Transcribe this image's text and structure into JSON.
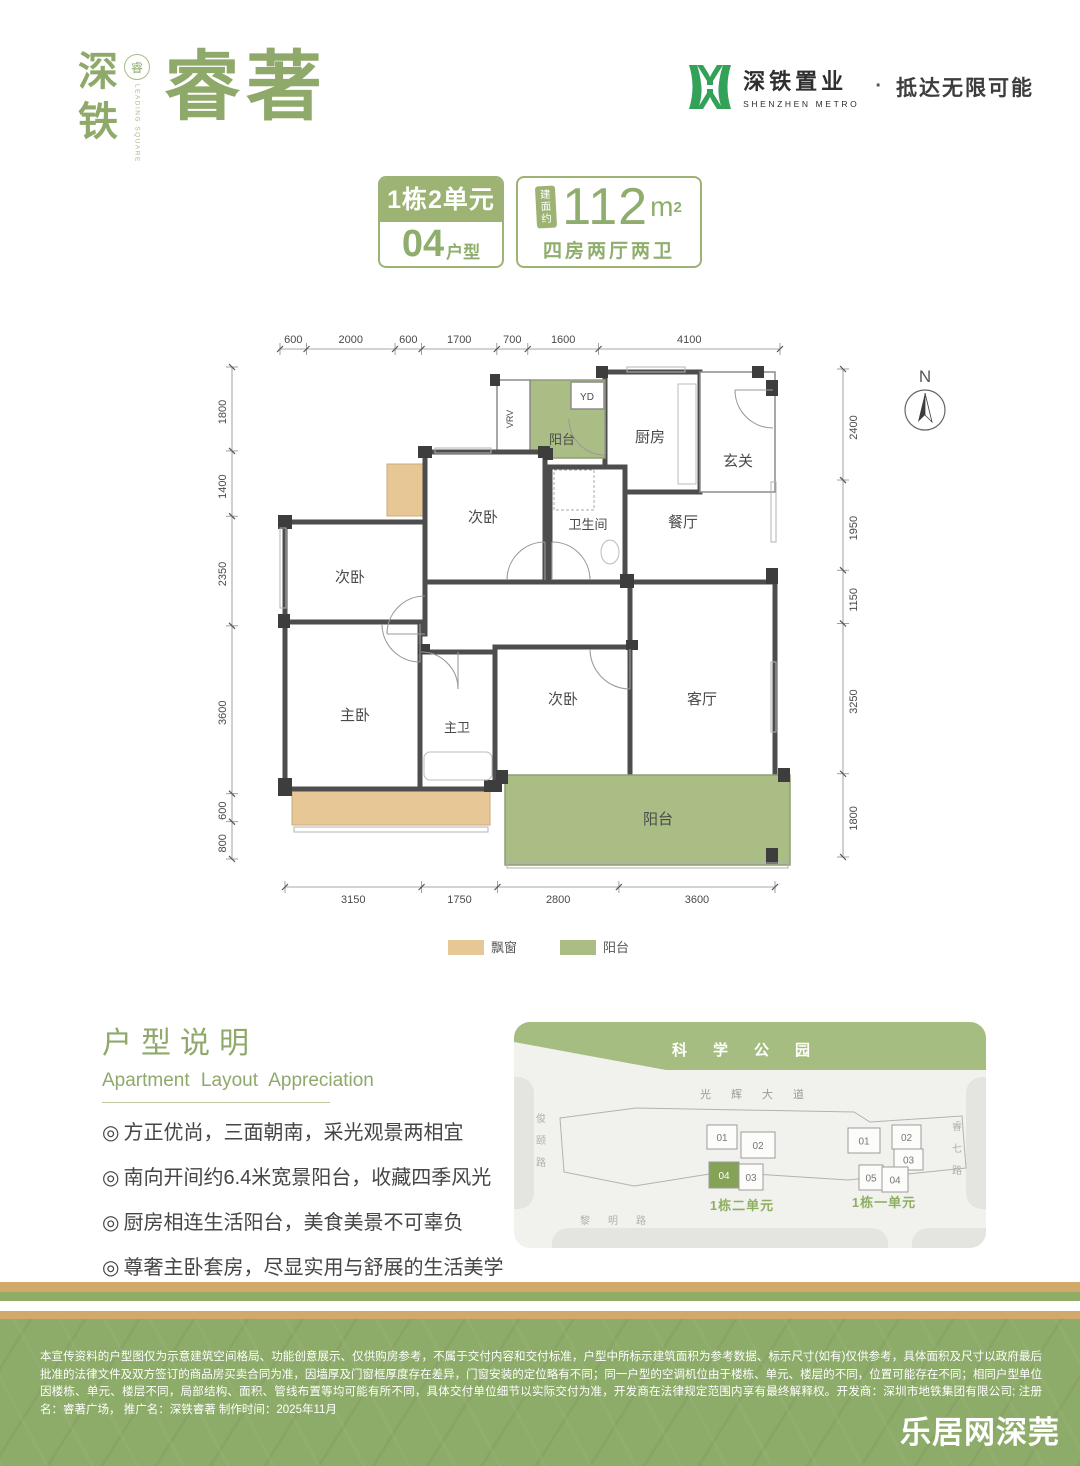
{
  "header": {
    "logo_vertical": "深铁",
    "logo_seal_char": "睿",
    "logo_seal_text": "LEADING SQUARE",
    "logo_main": "睿著",
    "brand_cn": "深铁置业",
    "brand_en": "SHENZHEN METRO",
    "dot": "·",
    "tagline": "抵达无限可能"
  },
  "badges": {
    "block": "1栋2单元",
    "unit_num": "04",
    "unit_suffix": "户型",
    "area_tag": "建面约",
    "area_num": "112",
    "area_unit": "m",
    "area_sup": "2",
    "rooms_desc": "四房两厅两卫"
  },
  "floorplan": {
    "compass": {
      "label": "N",
      "x": 745,
      "y": 88,
      "r": 20
    },
    "dims": {
      "top": {
        "y": 27,
        "from": 100,
        "to": 600,
        "values": [
          600,
          2000,
          600,
          1700,
          700,
          1600,
          4100
        ]
      },
      "left": {
        "x": 52,
        "from": 45,
        "to": 537,
        "values": [
          1800,
          1400,
          2350,
          3600,
          600,
          800
        ]
      },
      "right": {
        "x": 663,
        "from": 47,
        "to": 535,
        "values": [
          2400,
          1950,
          1150,
          3250,
          1800
        ]
      },
      "bottom": {
        "y": 565,
        "from": 105,
        "to": 595,
        "values": [
          3150,
          1750,
          2800,
          3600
        ]
      }
    },
    "rooms": [
      {
        "label": "厨房",
        "x": 425,
        "y": 50,
        "w": 95,
        "h": 120,
        "fill": "white",
        "stroke": "wall",
        "lx": 470,
        "ly": 120,
        "fs": 15
      },
      {
        "label": "玄关",
        "x": 520,
        "y": 50,
        "w": 75,
        "h": 120,
        "fill": "white",
        "stroke": "thin",
        "lx": 558,
        "ly": 144,
        "fs": 15
      },
      {
        "label": "阳台",
        "x": 350,
        "y": 58,
        "w": 75,
        "h": 78,
        "fill": "balcony",
        "stroke": "glass",
        "lx": 382,
        "ly": 122,
        "fs": 13
      },
      {
        "label": "YD",
        "x": 391,
        "y": 60,
        "w": 33,
        "h": 27,
        "fill": "white",
        "stroke": "thin",
        "lx": 407,
        "ly": 78,
        "fs": 10
      },
      {
        "label": "VRV",
        "x": 317,
        "y": 58,
        "w": 33,
        "h": 78,
        "fill": "white",
        "stroke": "thin",
        "lx": 333,
        "ly": 97,
        "fs": 9,
        "vertical": true
      },
      {
        "label": "次卧",
        "x": 245,
        "y": 130,
        "w": 120,
        "h": 130,
        "fill": "white",
        "stroke": "wall",
        "lx": 303,
        "ly": 200,
        "fs": 15
      },
      {
        "label": "卫生间",
        "x": 370,
        "y": 145,
        "w": 75,
        "h": 115,
        "fill": "white",
        "stroke": "wall",
        "lx": 408,
        "ly": 207,
        "fs": 13
      },
      {
        "label": "餐厅",
        "x": 445,
        "y": 170,
        "w": 150,
        "h": 90,
        "fill": "none",
        "stroke": "none",
        "lx": 503,
        "ly": 205,
        "fs": 15
      },
      {
        "label": "次卧",
        "x": 105,
        "y": 200,
        "w": 140,
        "h": 112,
        "fill": "white",
        "stroke": "wall",
        "lx": 170,
        "ly": 260,
        "fs": 15
      },
      {
        "label": "主卧",
        "x": 105,
        "y": 300,
        "w": 135,
        "h": 167,
        "fill": "white",
        "stroke": "wall",
        "lx": 175,
        "ly": 398,
        "fs": 15
      },
      {
        "label": "主卫",
        "x": 240,
        "y": 330,
        "w": 75,
        "h": 137,
        "fill": "white",
        "stroke": "wall",
        "lx": 277,
        "ly": 410,
        "fs": 13
      },
      {
        "label": "次卧",
        "x": 315,
        "y": 325,
        "w": 135,
        "h": 130,
        "fill": "white",
        "stroke": "wall",
        "lx": 383,
        "ly": 382,
        "fs": 15
      },
      {
        "label": "客厅",
        "x": 450,
        "y": 260,
        "w": 145,
        "h": 207,
        "fill": "white",
        "stroke": "wall",
        "lx": 522,
        "ly": 382,
        "fs": 15
      },
      {
        "label": "阳台",
        "x": 325,
        "y": 453,
        "w": 285,
        "h": 90,
        "fill": "balcony",
        "stroke": "glass",
        "lx": 478,
        "ly": 502,
        "fs": 15
      }
    ],
    "bays": [
      {
        "x": 108,
        "y": 204,
        "w": 28,
        "h": 84
      },
      {
        "x": 207,
        "y": 142,
        "w": 40,
        "h": 52
      },
      {
        "x": 112,
        "y": 469,
        "w": 198,
        "h": 34
      }
    ],
    "legend": [
      {
        "label": "飘窗",
        "color": "#e6c795"
      },
      {
        "label": "阳台",
        "color": "#a9bd84"
      }
    ]
  },
  "description": {
    "title": "户型说明",
    "subtitle": "Apartment Layout Appreciation",
    "marker": "◎",
    "bullets": [
      "方正优尚，三面朝南，采光观景两相宜",
      "南向开间约6.4米宽景阳台，收藏四季风光",
      "厨房相连生活阳台，美食美景不可辜负",
      "尊奢主卧套房，尽显实用与舒展的生活美学"
    ]
  },
  "sitemap": {
    "park": "科学公园",
    "road_top": "光辉大道",
    "road_left": "俊颐路",
    "road_right": "睿七路",
    "road_bottom": "黎明路",
    "clusters": [
      {
        "label": "1栋二单元",
        "lx": 228,
        "ly": 188,
        "buildings": [
          {
            "n": "01",
            "x": 193,
            "y": 103,
            "w": 30,
            "h": 24
          },
          {
            "n": "02",
            "x": 227,
            "y": 110,
            "w": 34,
            "h": 26
          },
          {
            "n": "04",
            "x": 195,
            "y": 140,
            "w": 30,
            "h": 26,
            "hl": true
          },
          {
            "n": "03",
            "x": 225,
            "y": 142,
            "w": 24,
            "h": 26
          }
        ]
      },
      {
        "label": "1栋一单元",
        "lx": 370,
        "ly": 185,
        "buildings": [
          {
            "n": "01",
            "x": 334,
            "y": 106,
            "w": 32,
            "h": 25
          },
          {
            "n": "02",
            "x": 378,
            "y": 103,
            "w": 29,
            "h": 24
          },
          {
            "n": "03",
            "x": 380,
            "y": 127,
            "w": 29,
            "h": 21
          },
          {
            "n": "05",
            "x": 345,
            "y": 143,
            "w": 24,
            "h": 25
          },
          {
            "n": "04",
            "x": 368,
            "y": 145,
            "w": 26,
            "h": 25
          }
        ]
      }
    ]
  },
  "footer": {
    "disclaimer": "本宣传资料的户型图仅为示意建筑空间格局、功能创意展示、仅供购房参考，不属于交付内容和交付标准，户型中所标示建筑面积为参考数据、标示尺寸(如有)仅供参考，具体面积及尺寸以政府最后批准的法律文件及双方签订的商品房买卖合同为准，因墙厚及门窗框厚度存在差异，门窗安装的定位略有不同；同一户型的空调机位由于楼栋、单元、楼层的不同，位置可能存在不同；相同户型单位因楼栋、单元、楼层不同，局部结构、面积、管线布置等均可能有所不同，具体交付单位细节以实际交付为准，开发商在法律规定范围内享有最终解释权。开发商：深圳市地铁集团有限公司; 注册名：睿著广场， 推广名：深铁睿著  制作时间：2025年11月",
    "watermark": "乐居网深莞"
  },
  "colors": {
    "accent_green": "#8fa96b",
    "badge_green": "#9cb374",
    "metro_green": "#33a157",
    "wall": "#4d4d4d",
    "bay": "#e6c795",
    "balcony": "#a9bd84",
    "sitemap_banner": "#a5bd81",
    "footer_green": "#8dab69",
    "stripe_tan": "#d0a96b",
    "stripe_green": "#8fac67"
  }
}
